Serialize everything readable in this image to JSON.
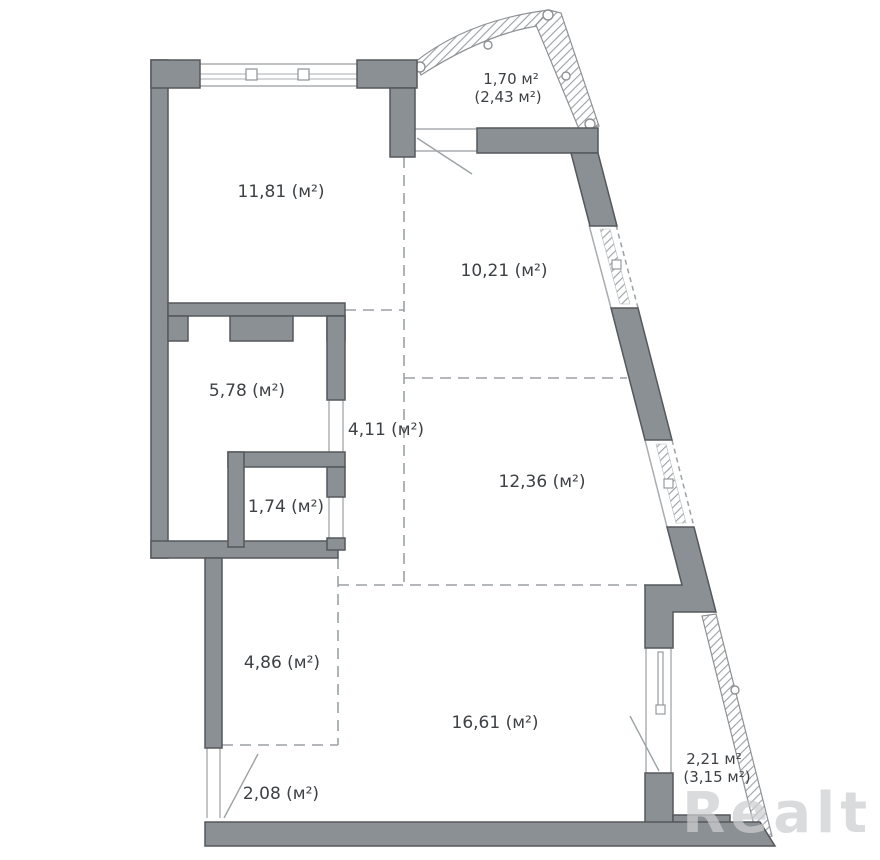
{
  "document": {
    "type": "apartment-floor-plan",
    "units": "м²"
  },
  "rooms": {
    "balcony_top": {
      "line1": "1,70 м²",
      "line2": "(2,43 м²)"
    },
    "room_11_81": {
      "label": "11,81 (м²)"
    },
    "room_10_21": {
      "label": "10,21 (м²)"
    },
    "room_5_78": {
      "label": "5,78 (м²)"
    },
    "hall_4_11": {
      "label": "4,11 (м²)"
    },
    "room_1_74": {
      "label": "1,74 (м²)"
    },
    "room_12_36": {
      "label": "12,36 (м²)"
    },
    "room_4_86": {
      "label": "4,86 (м²)"
    },
    "room_16_61": {
      "label": "16,61 (м²)"
    },
    "room_2_08": {
      "label": "2,08 (м²)"
    },
    "balcony_bottom": {
      "line1": "2,21 м²",
      "line2": "(3,15 м²)"
    }
  },
  "watermark": {
    "text": "Realt"
  },
  "colors": {
    "wall_fill": "#8b9095",
    "wall_outline": "#54585c",
    "dashed_line": "#9ba1a5",
    "thin_line": "#a8adb1",
    "label_text": "#3d4145",
    "watermark": "#cdced0"
  }
}
